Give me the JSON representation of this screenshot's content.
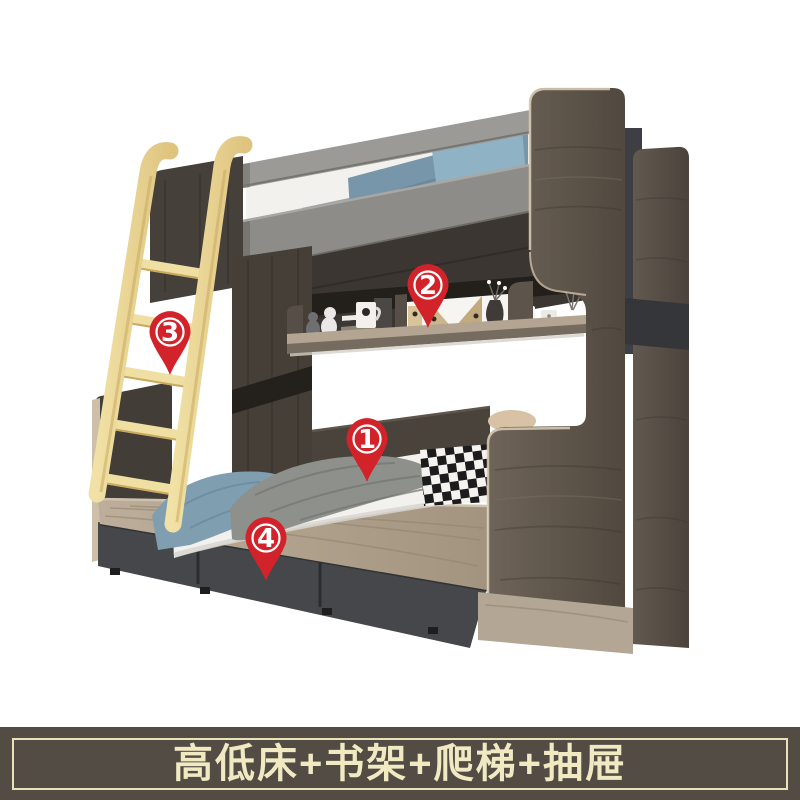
{
  "image_type": "furniture-product-photo",
  "caption": {
    "text": "高低床+书架+爬梯+抽屉"
  },
  "callouts": [
    {
      "number": "1",
      "target": "lower-bed",
      "x": 367,
      "y": 440
    },
    {
      "number": "2",
      "target": "bookshelf",
      "x": 428,
      "y": 286
    },
    {
      "number": "3",
      "target": "ladder",
      "x": 170,
      "y": 333
    },
    {
      "number": "4",
      "target": "drawers",
      "x": 266,
      "y": 539
    }
  ],
  "colors": {
    "callout_red": "#d2232a",
    "banner_bg": "#524c45",
    "banner_border": "#e9e2b9",
    "banner_text": "#f0e9c2",
    "guard_rail_gray": "#9b9a96",
    "dark_wood": "#4a443d",
    "right_panel_wood": "#675d52",
    "light_wood": "#b6a996",
    "drawer_gray": "#45474a",
    "ladder_yellow": "#ecd694",
    "blanket_blue": "#7f9fb1",
    "blanket_gray": "#8e908c",
    "mattress_white": "#f2f1ee"
  }
}
